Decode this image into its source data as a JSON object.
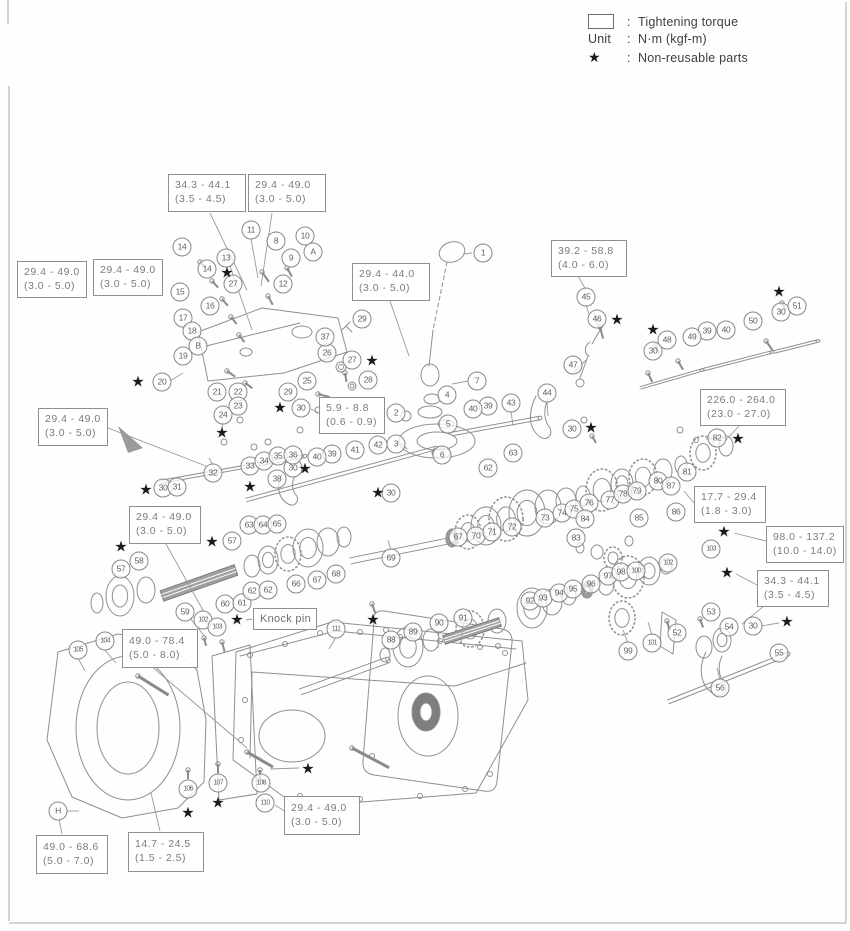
{
  "style": {
    "ink": "#8f8f8f",
    "box_text": "#7c7c7c",
    "star": "#1b1b1b",
    "legend_text": "#3f3f3f"
  },
  "legend": {
    "colon": ":",
    "torque_label": "Tightening torque",
    "unit_key": "Unit",
    "unit_value": "N·m (kgf-m)",
    "star_symbol": "★",
    "star_label": "Non-reusable parts"
  },
  "knock_pin": {
    "label": "Knock pin",
    "x": 253,
    "y": 608,
    "w": 64,
    "h": 22
  },
  "torque_boxes": [
    {
      "line1": "34.3 - 44.1",
      "line2": "(3.5 - 4.5)",
      "x": 168,
      "y": 174,
      "w": 78,
      "h": 38
    },
    {
      "line1": "29.4 - 49.0",
      "line2": "(3.0 - 5.0)",
      "x": 248,
      "y": 174,
      "w": 78,
      "h": 38
    },
    {
      "line1": "29.4 - 49.0",
      "line2": "(3.0 - 5.0)",
      "x": 17,
      "y": 261,
      "w": 70,
      "h": 37
    },
    {
      "line1": "29.4 - 49.0",
      "line2": "(3.0 - 5.0)",
      "x": 93,
      "y": 259,
      "w": 70,
      "h": 37
    },
    {
      "line1": "29.4 - 44.0",
      "line2": "(3.0 - 5.0)",
      "x": 352,
      "y": 263,
      "w": 78,
      "h": 38
    },
    {
      "line1": "39.2 - 58.8",
      "line2": "(4.0 - 6.0)",
      "x": 551,
      "y": 240,
      "w": 76,
      "h": 37
    },
    {
      "line1": "226.0 - 264.0",
      "line2": "(23.0 - 27.0)",
      "x": 700,
      "y": 389,
      "w": 86,
      "h": 37
    },
    {
      "line1": "5.9 - 8.8",
      "line2": "(0.6 - 0.9)",
      "x": 319,
      "y": 397,
      "w": 66,
      "h": 37
    },
    {
      "line1": "29.4 - 49.0",
      "line2": "(3.0 - 5.0)",
      "x": 38,
      "y": 408,
      "w": 70,
      "h": 38
    },
    {
      "line1": "29.4 - 49.0",
      "line2": "(3.0 - 5.0)",
      "x": 129,
      "y": 506,
      "w": 72,
      "h": 38
    },
    {
      "line1": "17.7 - 29.4",
      "line2": "(1.8 - 3.0)",
      "x": 694,
      "y": 486,
      "w": 72,
      "h": 37
    },
    {
      "line1": "98.0 - 137.2",
      "line2": "(10.0 - 14.0)",
      "x": 766,
      "y": 526,
      "w": 78,
      "h": 37
    },
    {
      "line1": "34.3 - 44.1",
      "line2": "(3.5 - 4.5)",
      "x": 757,
      "y": 570,
      "w": 72,
      "h": 37
    },
    {
      "line1": "49.0 - 78.4",
      "line2": "(5.0 - 8.0)",
      "x": 122,
      "y": 629,
      "w": 76,
      "h": 39
    },
    {
      "line1": "49.0 - 68.6",
      "line2": "(5.0 - 7.0)",
      "x": 36,
      "y": 835,
      "w": 72,
      "h": 39
    },
    {
      "line1": "14.7 - 24.5",
      "line2": "(1.5 - 2.5)",
      "x": 128,
      "y": 832,
      "w": 76,
      "h": 40
    },
    {
      "line1": "29.4 - 49.0",
      "line2": "(3.0 - 5.0)",
      "x": 284,
      "y": 796,
      "w": 76,
      "h": 39
    }
  ],
  "callouts": [
    {
      "t": "1",
      "x": 483,
      "y": 253
    },
    {
      "t": "2",
      "x": 396,
      "y": 413
    },
    {
      "t": "3",
      "x": 396,
      "y": 444
    },
    {
      "t": "4",
      "x": 447,
      "y": 395
    },
    {
      "t": "5",
      "x": 448,
      "y": 424
    },
    {
      "t": "6",
      "x": 442,
      "y": 455
    },
    {
      "t": "7",
      "x": 477,
      "y": 381
    },
    {
      "t": "8",
      "x": 276,
      "y": 241
    },
    {
      "t": "9",
      "x": 291,
      "y": 258
    },
    {
      "t": "10",
      "x": 305,
      "y": 236
    },
    {
      "t": "A",
      "x": 313,
      "y": 252
    },
    {
      "t": "11",
      "x": 251,
      "y": 230
    },
    {
      "t": "12",
      "x": 283,
      "y": 284
    },
    {
      "t": "13",
      "x": 226,
      "y": 258
    },
    {
      "t": "14",
      "x": 182,
      "y": 247
    },
    {
      "t": "14",
      "x": 207,
      "y": 269
    },
    {
      "t": "15",
      "x": 180,
      "y": 292
    },
    {
      "t": "16",
      "x": 210,
      "y": 306
    },
    {
      "t": "17",
      "x": 183,
      "y": 318
    },
    {
      "t": "18",
      "x": 192,
      "y": 331
    },
    {
      "t": "B",
      "x": 198,
      "y": 346
    },
    {
      "t": "19",
      "x": 183,
      "y": 356
    },
    {
      "t": "20",
      "x": 162,
      "y": 382
    },
    {
      "t": "21",
      "x": 217,
      "y": 392
    },
    {
      "t": "22",
      "x": 238,
      "y": 392
    },
    {
      "t": "23",
      "x": 238,
      "y": 406
    },
    {
      "t": "24",
      "x": 223,
      "y": 415
    },
    {
      "t": "25",
      "x": 307,
      "y": 381
    },
    {
      "t": "26",
      "x": 327,
      "y": 353
    },
    {
      "t": "27",
      "x": 233,
      "y": 284
    },
    {
      "t": "27",
      "x": 352,
      "y": 360
    },
    {
      "t": "28",
      "x": 368,
      "y": 380
    },
    {
      "t": "29",
      "x": 362,
      "y": 319
    },
    {
      "t": "29",
      "x": 288,
      "y": 392
    },
    {
      "t": "30",
      "x": 301,
      "y": 408
    },
    {
      "t": "30",
      "x": 163,
      "y": 488
    },
    {
      "t": "30",
      "x": 293,
      "y": 468
    },
    {
      "t": "30",
      "x": 391,
      "y": 493
    },
    {
      "t": "30",
      "x": 572,
      "y": 429
    },
    {
      "t": "30",
      "x": 653,
      "y": 351
    },
    {
      "t": "30",
      "x": 781,
      "y": 312
    },
    {
      "t": "30",
      "x": 753,
      "y": 626
    },
    {
      "t": "31",
      "x": 177,
      "y": 487
    },
    {
      "t": "32",
      "x": 213,
      "y": 473
    },
    {
      "t": "33",
      "x": 250,
      "y": 466
    },
    {
      "t": "34",
      "x": 264,
      "y": 461
    },
    {
      "t": "35",
      "x": 278,
      "y": 456
    },
    {
      "t": "36",
      "x": 293,
      "y": 455
    },
    {
      "t": "37",
      "x": 325,
      "y": 337
    },
    {
      "t": "38",
      "x": 277,
      "y": 479
    },
    {
      "t": "39",
      "x": 332,
      "y": 454
    },
    {
      "t": "40",
      "x": 317,
      "y": 457
    },
    {
      "t": "39",
      "x": 488,
      "y": 406
    },
    {
      "t": "40",
      "x": 473,
      "y": 409
    },
    {
      "t": "39",
      "x": 707,
      "y": 331
    },
    {
      "t": "40",
      "x": 726,
      "y": 330
    },
    {
      "t": "41",
      "x": 355,
      "y": 450
    },
    {
      "t": "42",
      "x": 378,
      "y": 445
    },
    {
      "t": "43",
      "x": 511,
      "y": 403
    },
    {
      "t": "44",
      "x": 547,
      "y": 393
    },
    {
      "t": "45",
      "x": 586,
      "y": 297
    },
    {
      "t": "46",
      "x": 597,
      "y": 319
    },
    {
      "t": "47",
      "x": 573,
      "y": 365
    },
    {
      "t": "48",
      "x": 667,
      "y": 340
    },
    {
      "t": "49",
      "x": 692,
      "y": 337
    },
    {
      "t": "50",
      "x": 753,
      "y": 321
    },
    {
      "t": "51",
      "x": 797,
      "y": 306
    },
    {
      "t": "52",
      "x": 677,
      "y": 633
    },
    {
      "t": "53",
      "x": 711,
      "y": 612
    },
    {
      "t": "54",
      "x": 729,
      "y": 627
    },
    {
      "t": "55",
      "x": 779,
      "y": 653
    },
    {
      "t": "56",
      "x": 720,
      "y": 688
    },
    {
      "t": "57",
      "x": 232,
      "y": 541
    },
    {
      "t": "57",
      "x": 121,
      "y": 569
    },
    {
      "t": "58",
      "x": 139,
      "y": 561
    },
    {
      "t": "59",
      "x": 185,
      "y": 612
    },
    {
      "t": "60",
      "x": 225,
      "y": 604
    },
    {
      "t": "61",
      "x": 242,
      "y": 603
    },
    {
      "t": "62",
      "x": 252,
      "y": 591
    },
    {
      "t": "62",
      "x": 268,
      "y": 590
    },
    {
      "t": "62",
      "x": 488,
      "y": 468
    },
    {
      "t": "63",
      "x": 249,
      "y": 525
    },
    {
      "t": "63",
      "x": 513,
      "y": 453
    },
    {
      "t": "64",
      "x": 263,
      "y": 525
    },
    {
      "t": "65",
      "x": 277,
      "y": 524
    },
    {
      "t": "66",
      "x": 296,
      "y": 584
    },
    {
      "t": "67",
      "x": 317,
      "y": 580
    },
    {
      "t": "67",
      "x": 458,
      "y": 537
    },
    {
      "t": "68",
      "x": 336,
      "y": 574
    },
    {
      "t": "69",
      "x": 391,
      "y": 558
    },
    {
      "t": "70",
      "x": 476,
      "y": 536
    },
    {
      "t": "71",
      "x": 492,
      "y": 532
    },
    {
      "t": "72",
      "x": 512,
      "y": 527
    },
    {
      "t": "73",
      "x": 545,
      "y": 518
    },
    {
      "t": "74",
      "x": 562,
      "y": 513
    },
    {
      "t": "75",
      "x": 574,
      "y": 509
    },
    {
      "t": "76",
      "x": 589,
      "y": 503
    },
    {
      "t": "77",
      "x": 610,
      "y": 500
    },
    {
      "t": "78",
      "x": 623,
      "y": 494
    },
    {
      "t": "79",
      "x": 637,
      "y": 491
    },
    {
      "t": "80",
      "x": 658,
      "y": 481
    },
    {
      "t": "81",
      "x": 687,
      "y": 472
    },
    {
      "t": "82",
      "x": 717,
      "y": 438
    },
    {
      "t": "83",
      "x": 576,
      "y": 538
    },
    {
      "t": "84",
      "x": 585,
      "y": 519
    },
    {
      "t": "85",
      "x": 639,
      "y": 518
    },
    {
      "t": "86",
      "x": 676,
      "y": 512
    },
    {
      "t": "87",
      "x": 671,
      "y": 486
    },
    {
      "t": "88",
      "x": 391,
      "y": 640
    },
    {
      "t": "89",
      "x": 413,
      "y": 632
    },
    {
      "t": "90",
      "x": 439,
      "y": 623
    },
    {
      "t": "91",
      "x": 463,
      "y": 618
    },
    {
      "t": "92",
      "x": 530,
      "y": 601
    },
    {
      "t": "93",
      "x": 543,
      "y": 598
    },
    {
      "t": "94",
      "x": 559,
      "y": 593
    },
    {
      "t": "95",
      "x": 573,
      "y": 589
    },
    {
      "t": "96",
      "x": 591,
      "y": 584
    },
    {
      "t": "97",
      "x": 608,
      "y": 576
    },
    {
      "t": "98",
      "x": 621,
      "y": 572
    },
    {
      "t": "100",
      "x": 636,
      "y": 571
    },
    {
      "t": "99",
      "x": 628,
      "y": 651
    },
    {
      "t": "101",
      "x": 652,
      "y": 643
    },
    {
      "t": "102",
      "x": 668,
      "y": 563
    },
    {
      "t": "103",
      "x": 711,
      "y": 549
    },
    {
      "t": "102",
      "x": 203,
      "y": 620
    },
    {
      "t": "103",
      "x": 217,
      "y": 627
    },
    {
      "t": "104",
      "x": 105,
      "y": 641
    },
    {
      "t": "105",
      "x": 78,
      "y": 650
    },
    {
      "t": "106",
      "x": 188,
      "y": 789
    },
    {
      "t": "107",
      "x": 218,
      "y": 783
    },
    {
      "t": "108",
      "x": 261,
      "y": 783
    },
    {
      "t": "110",
      "x": 265,
      "y": 803
    },
    {
      "t": "111",
      "x": 336,
      "y": 629
    },
    {
      "t": "H",
      "x": 58,
      "y": 811
    }
  ],
  "stars": [
    {
      "x": 227,
      "y": 273
    },
    {
      "x": 372,
      "y": 361
    },
    {
      "x": 138,
      "y": 382
    },
    {
      "x": 222,
      "y": 433
    },
    {
      "x": 280,
      "y": 408
    },
    {
      "x": 146,
      "y": 490
    },
    {
      "x": 250,
      "y": 487
    },
    {
      "x": 305,
      "y": 469
    },
    {
      "x": 378,
      "y": 493
    },
    {
      "x": 212,
      "y": 542
    },
    {
      "x": 121,
      "y": 547
    },
    {
      "x": 237,
      "y": 620
    },
    {
      "x": 373,
      "y": 620
    },
    {
      "x": 591,
      "y": 428
    },
    {
      "x": 653,
      "y": 330
    },
    {
      "x": 617,
      "y": 320
    },
    {
      "x": 779,
      "y": 292
    },
    {
      "x": 738,
      "y": 439
    },
    {
      "x": 724,
      "y": 532
    },
    {
      "x": 727,
      "y": 573
    },
    {
      "x": 787,
      "y": 622
    },
    {
      "x": 188,
      "y": 813
    },
    {
      "x": 218,
      "y": 803
    },
    {
      "x": 308,
      "y": 769
    }
  ]
}
